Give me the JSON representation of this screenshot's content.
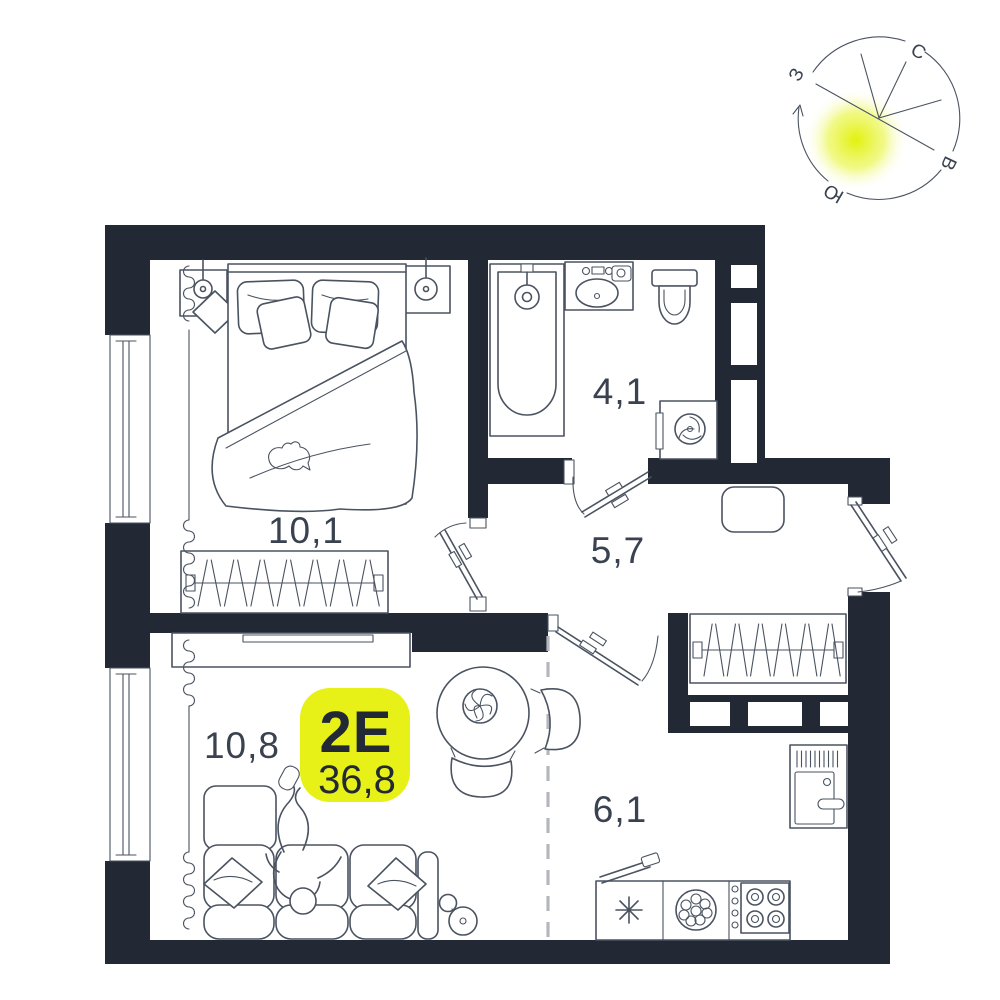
{
  "plan": {
    "type_label": "2Е",
    "total_area": "36,8",
    "rooms": [
      {
        "name": "bedroom",
        "area": "10,1"
      },
      {
        "name": "bathroom",
        "area": "4,1"
      },
      {
        "name": "hallway",
        "area": "5,7"
      },
      {
        "name": "living-room",
        "area": "10,8"
      },
      {
        "name": "kitchen",
        "area": "6,1"
      }
    ],
    "compass": {
      "north": "С",
      "east": "В",
      "south": "Ю",
      "west": "З"
    },
    "colors": {
      "wall": "#222934",
      "furniture_line": "#4a5360",
      "accent": "#e7f118",
      "label": "#39424e",
      "dash": "#b3b7bd",
      "background": "#ffffff"
    }
  }
}
